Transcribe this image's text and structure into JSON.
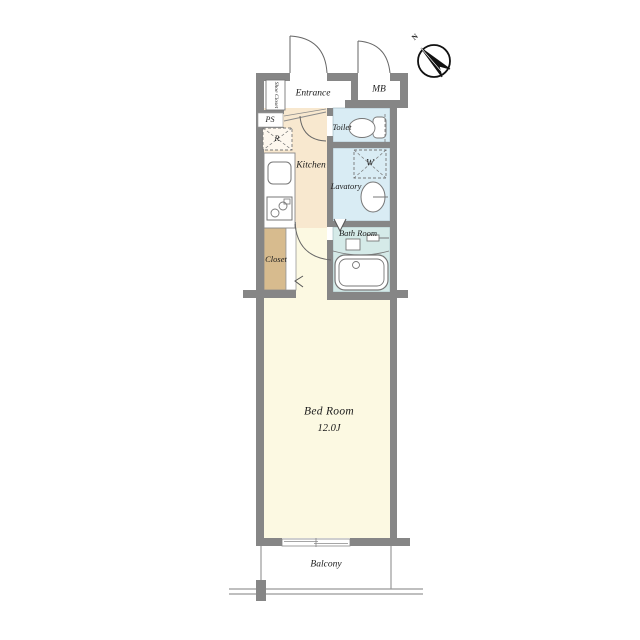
{
  "floorplan": {
    "labels": {
      "entrance": "Entrance",
      "mb": "MB",
      "shoe_closet": "Shoe Closet",
      "ps": "PS",
      "refrigerator": "R",
      "kitchen": "Kitchen",
      "toilet": "Toilet",
      "washer": "W",
      "lavatory": "Lavatory",
      "bath_room": "Bath Room",
      "closet": "Closet",
      "bed_room": "Bed Room",
      "bed_room_size": "12.0J",
      "balcony": "Balcony",
      "north": "N"
    },
    "colors": {
      "wall": "#868686",
      "kitchen_floor": "#f8e8cf",
      "wet_area_floor": "#d9ecf4",
      "bath_floor": "#d5eae8",
      "closet_floor": "#d7bb8e",
      "bedroom_floor": "#fcf9e2",
      "outline": "#666666"
    }
  }
}
